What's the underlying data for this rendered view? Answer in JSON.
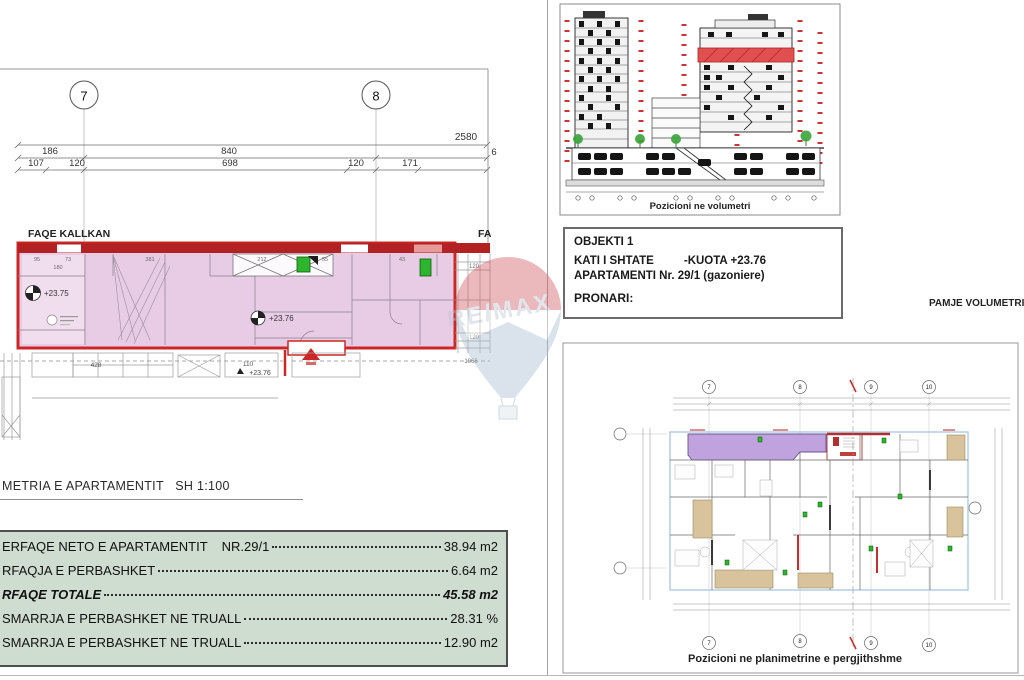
{
  "colors": {
    "apartment_fill": "#e8cce6",
    "outline_red": "#cc2727",
    "band_red": "#b32222",
    "table_bg": "#cfdcd0",
    "purple_fill": "#c0a2de",
    "tan": "#d9c39c",
    "green_marker": "#2db52d",
    "elevation_red": "#e05050"
  },
  "grid_top_left": {
    "bubble_7": "7",
    "bubble_8": "8"
  },
  "dimensions": {
    "total": "2580",
    "row2": [
      "186",
      "840",
      "6"
    ],
    "row3": [
      "107",
      "120",
      "698",
      "120",
      "171"
    ],
    "inner": [
      "95",
      "73",
      "180",
      "381",
      "212",
      "55",
      "43"
    ],
    "right": [
      "120",
      "120",
      "1066"
    ],
    "below": [
      "428",
      "110"
    ]
  },
  "labels": {
    "faqe_kallkan": "FAQE KALLKAN",
    "fa_cut": "FA",
    "level_a": "+23.75",
    "level_b": "+23.76",
    "level_c": "+23.76",
    "scale_line": "METRIA E APARTAMENTIT",
    "scale_value": "SH  1:100",
    "pamje": "PAMJE VOLUMETRI"
  },
  "info_box": {
    "line1": "OBJEKTI 1",
    "line2a": "KATI I SHTATE",
    "line2b": "-KUOTA +23.76",
    "line3": "APARTAMENTI Nr. 29/1 (gazoniere)",
    "line4": "PRONARI:"
  },
  "elevation": {
    "caption": "Pozicioni ne volumetri"
  },
  "site_plan": {
    "caption": "Pozicioni ne planimetrine e pergjithshme",
    "bubbles_top": [
      "7",
      "8",
      "9",
      "10"
    ],
    "bubbles_bottom": [
      "7",
      "8",
      "9",
      "10"
    ]
  },
  "area_table": {
    "rows": [
      {
        "label": "ERFAQE NETO E APARTAMENTIT",
        "ref": "NR.29/1",
        "value": "38.94 m2"
      },
      {
        "label": "RFAQJA E PERBASHKET ",
        "ref": "",
        "value": "6.64 m2"
      },
      {
        "label": "RFAQE TOTALE ",
        "ref": "",
        "value": "45.58 m2"
      },
      {
        "label": "SMARRJA E PERBASHKET NE TRUALL ",
        "ref": "",
        "value": "28.31 %"
      },
      {
        "label": "SMARRJA E PERBASHKET NE TRUALL ",
        "ref": "",
        "value": "12.90 m2"
      }
    ]
  },
  "watermark": {
    "text": "RE/MAX"
  }
}
